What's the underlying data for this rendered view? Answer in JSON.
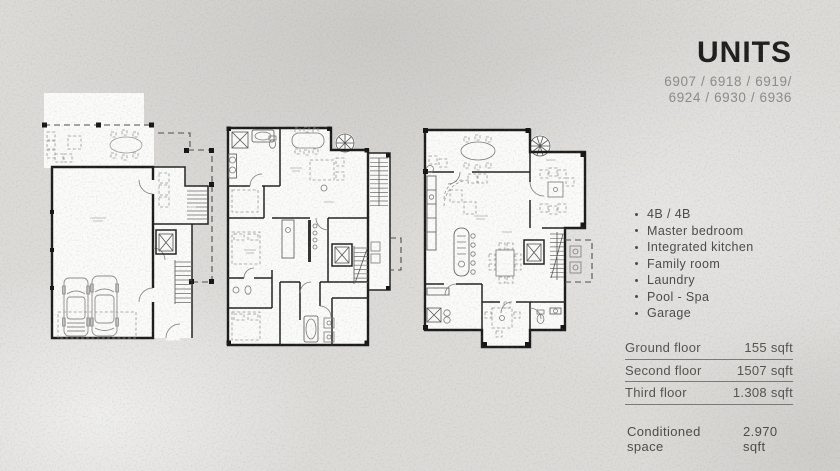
{
  "panel": {
    "title": "UNITS",
    "unit_numbers": [
      "6907 / 6918 / 6919/",
      "6924 / 6930 / 6936"
    ],
    "features": [
      "4B / 4B",
      "Master bedroom",
      "Integrated kitchen",
      "Family room",
      "Laundry",
      "Pool - Spa",
      "Garage"
    ],
    "floor_table": {
      "rows": [
        {
          "label": "Ground floor",
          "value": "155 sqft"
        },
        {
          "label": "Second floor",
          "value": "1507 sqft"
        },
        {
          "label": "Third floor",
          "value": "1.308 sqft"
        }
      ]
    },
    "summary": {
      "label": "Conditioned space",
      "value": "2.970 sqft"
    }
  },
  "colors": {
    "background": "#dcdbd8",
    "plan_paper": "#fbfbfa",
    "wall_ink": "#1b1b1b",
    "title_ink": "#1d1d1b",
    "unit_numbers_gray": "#8d8b88",
    "body_ink": "#4b4a47",
    "rule_gray": "#7b7977"
  }
}
